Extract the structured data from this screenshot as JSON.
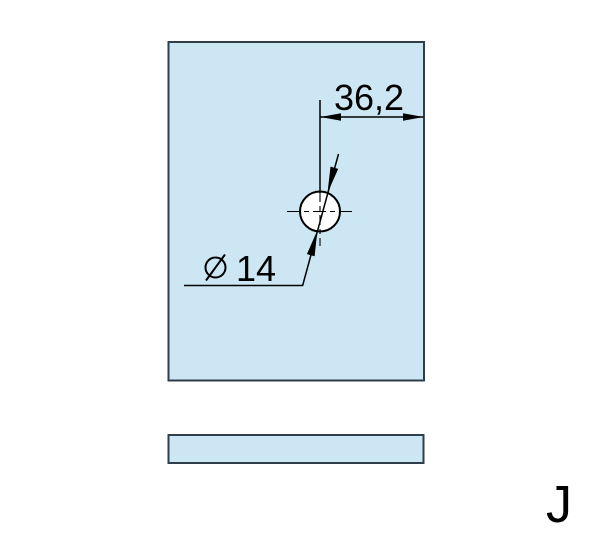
{
  "drawing": {
    "labels": {
      "horizontal_dimension": "36,2",
      "hole_diameter_symbol": "⌀",
      "hole_diameter_value": "14",
      "sheet_letter": "J"
    },
    "colors": {
      "background": "#ffffff",
      "panel_fill": "#cce7f3",
      "panel_stroke": "#2e3e4a",
      "line": "#000000",
      "hole_fill": "#ffffff"
    }
  }
}
